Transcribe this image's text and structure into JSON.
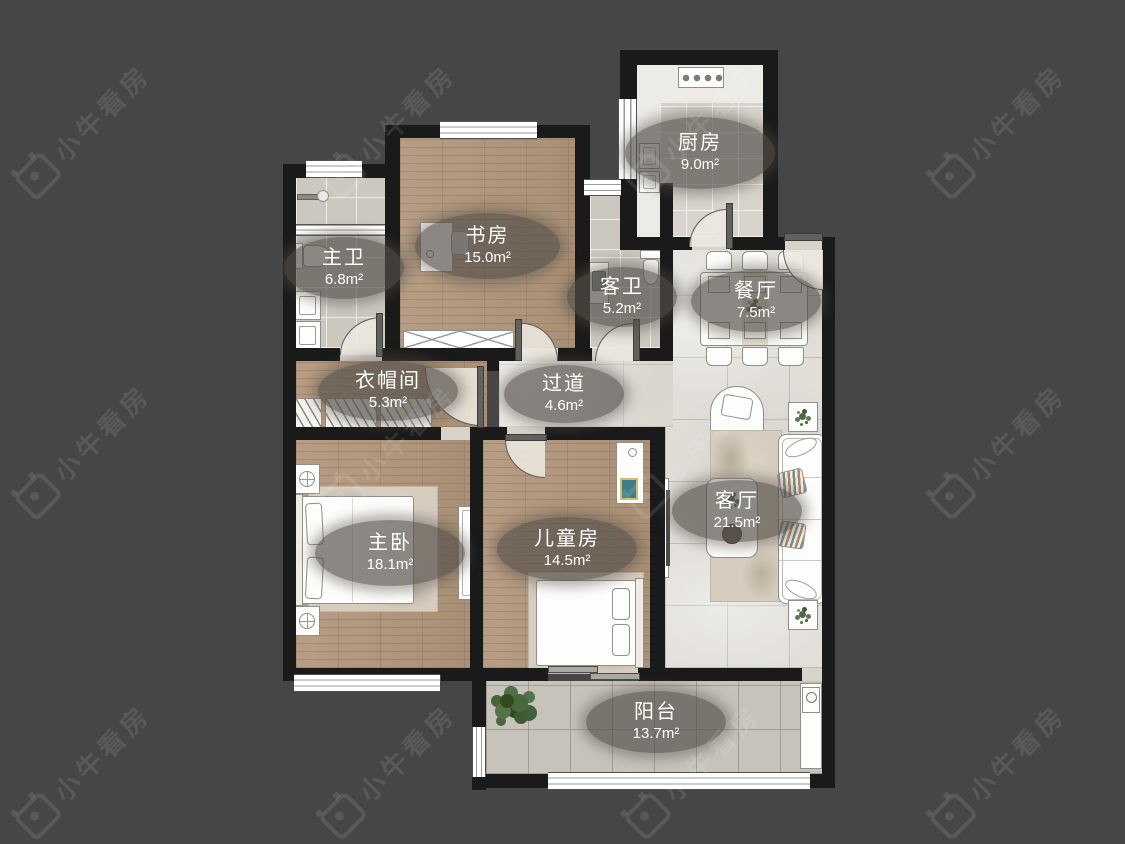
{
  "watermark": {
    "text": "小牛看房"
  },
  "palette": {
    "background": "#464646",
    "wall": "#1a1a1a",
    "label_bg": "rgba(84,80,74,0.68)",
    "label_text": "#ffffff",
    "wood_floor": "#b2977c",
    "bath_tile": "#ccc8c0",
    "marble_tile": "#e1ded8",
    "balcony_tile": "#c7c3bb",
    "kitchen_tile": "#d8d4cb"
  },
  "rooms": [
    {
      "id": "kitchen",
      "name": "厨房",
      "area": "9.0m²"
    },
    {
      "id": "master-bath",
      "name": "主卫",
      "area": "6.8m²"
    },
    {
      "id": "study",
      "name": "书房",
      "area": "15.0m²"
    },
    {
      "id": "guest-bath",
      "name": "客卫",
      "area": "5.2m²"
    },
    {
      "id": "dining",
      "name": "餐厅",
      "area": "7.5m²"
    },
    {
      "id": "cloakroom",
      "name": "衣帽间",
      "area": "5.3m²"
    },
    {
      "id": "hallway",
      "name": "过道",
      "area": "4.6m²"
    },
    {
      "id": "master-bedroom",
      "name": "主卧",
      "area": "18.1m²"
    },
    {
      "id": "kids-room",
      "name": "儿童房",
      "area": "14.5m²"
    },
    {
      "id": "living",
      "name": "客厅",
      "area": "21.5m²"
    },
    {
      "id": "balcony",
      "name": "阳台",
      "area": "13.7m²"
    }
  ]
}
